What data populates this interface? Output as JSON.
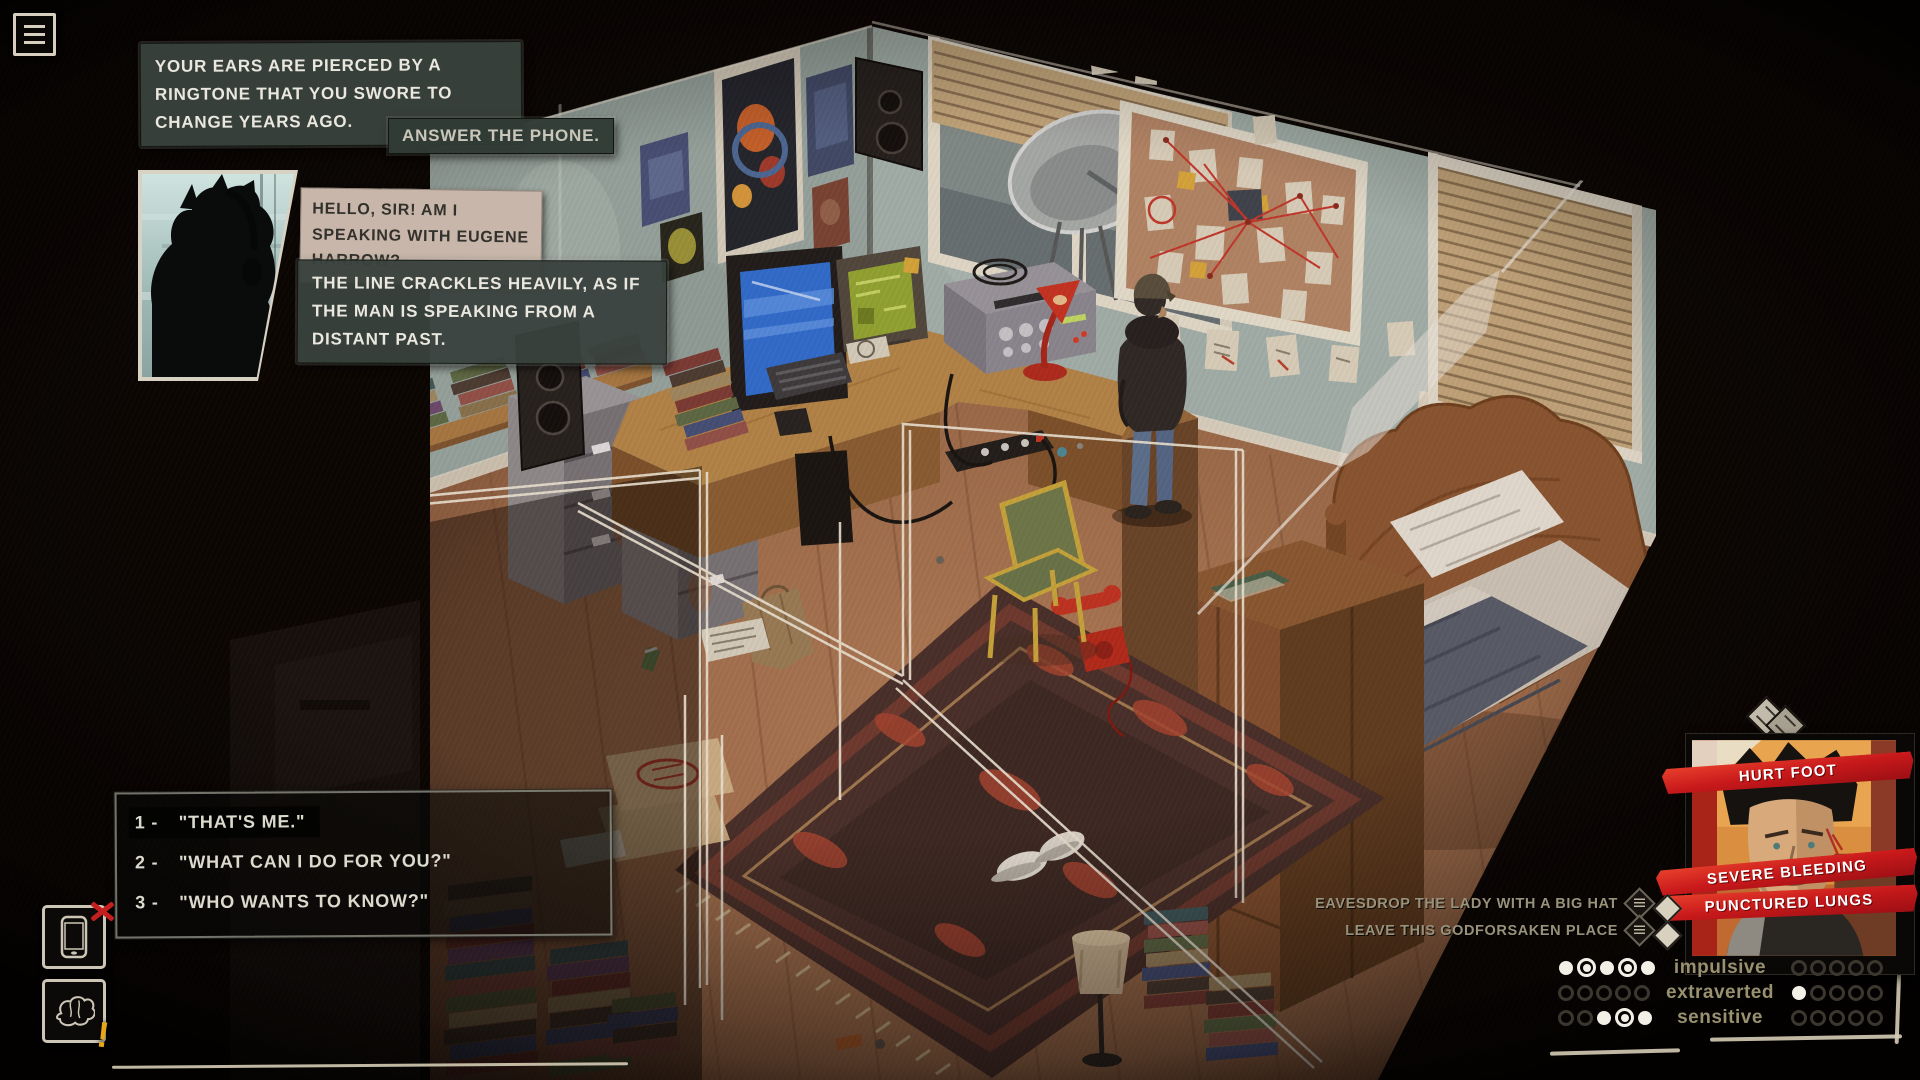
{
  "colors": {
    "accent_red": "#c8191b",
    "ui_cream": "#d6cfbf",
    "narration_bg": "#39423d",
    "speech_bg": "#c7b6a9",
    "trait_label": "#99906f",
    "banner_text": "#ffffff",
    "warning_yellow": "#e7a616"
  },
  "menu": {
    "label": "menu"
  },
  "narration1": {
    "text": "YOUR EARS ARE PIERCED BY A RINGTONE THAT YOU SWORE TO CHANGE YEARS AGO."
  },
  "action_prompt": {
    "text": "ANSWER THE PHONE."
  },
  "caller": {
    "speech": "HELLO, SIR! AM I SPEAKING WITH EUGENE HARROW?"
  },
  "narration2": {
    "text": "THE LINE CRACKLES HEAVILY, AS IF THE MAN IS SPEAKING FROM A DISTANT PAST."
  },
  "dialogue_options": [
    {
      "number": "1 -",
      "text": "\"THAT'S ME.\"",
      "highlighted": true
    },
    {
      "number": "2 -",
      "text": "\"WHAT CAN I DO FOR YOU?\"",
      "highlighted": false
    },
    {
      "number": "3 -",
      "text": "\"WHO WANTS TO KNOW?\"",
      "highlighted": false
    }
  ],
  "status_effects": [
    "HURT FOOT",
    "SEVERE BLEEDING",
    "PUNCTURED LUNGS"
  ],
  "world_actions": [
    "EAVESDROP THE LADY WITH A BIG HAT",
    "LEAVE THIS GODFORSAKEN PLACE"
  ],
  "traits": [
    {
      "label": "impulsive",
      "left": [
        "filled",
        "ring",
        "filled",
        "ring",
        "filled"
      ],
      "right": [
        "empty",
        "empty",
        "empty",
        "empty",
        "empty"
      ]
    },
    {
      "label": "extraverted",
      "left": [
        "empty",
        "empty",
        "empty",
        "empty",
        "empty"
      ],
      "right": [
        "filled",
        "empty",
        "empty",
        "empty",
        "empty"
      ]
    },
    {
      "label": "sensitive",
      "left": [
        "empty",
        "empty",
        "filled",
        "ring",
        "filled"
      ],
      "right": [
        "empty",
        "empty",
        "empty",
        "empty",
        "empty"
      ]
    }
  ]
}
